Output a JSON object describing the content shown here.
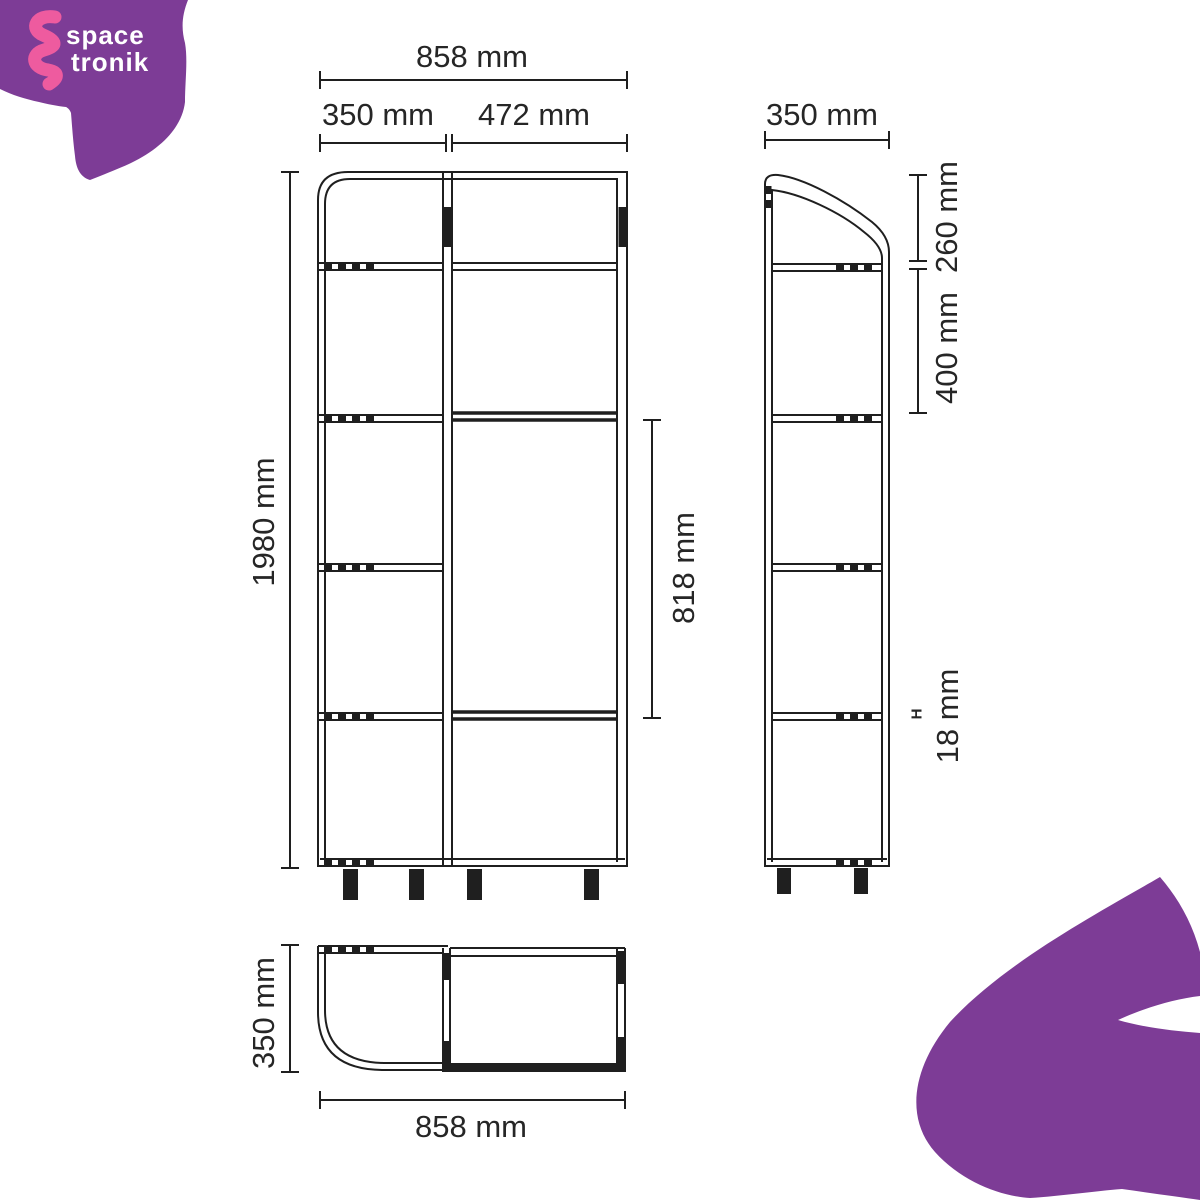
{
  "brand": {
    "logo_text_line1": "space",
    "logo_text_line2": "tronik"
  },
  "views": {
    "front": {
      "total_width": "858 mm",
      "left_section_width": "350 mm",
      "right_section_width": "472 mm",
      "total_height": "1980 mm",
      "right_opening_height": "818 mm"
    },
    "side": {
      "depth": "350 mm",
      "top_section_height": "260 mm",
      "shelf_spacing": "400 mm",
      "shelf_thickness_marker": "H",
      "shelf_thickness": "18 mm"
    },
    "plan": {
      "depth": "350 mm",
      "total_width": "858 mm"
    }
  },
  "colors": {
    "brand_purple": "#7d3c96",
    "brand_pink": "#ee5b9f",
    "line": "#1f1f1f",
    "text": "#262626"
  }
}
